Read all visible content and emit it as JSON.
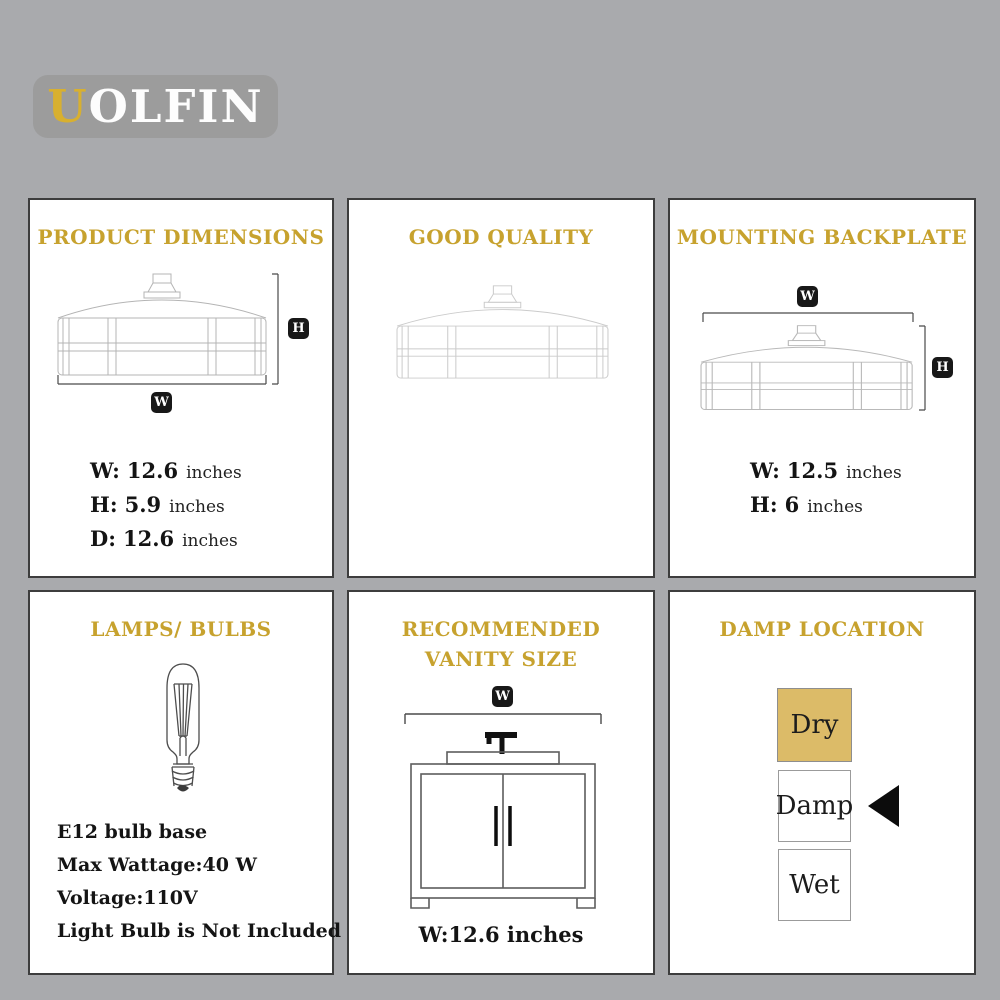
{
  "logo": {
    "first": "U",
    "rest": "OLFIN"
  },
  "badges": {
    "width": "W",
    "height": "H"
  },
  "cards": {
    "product_dimensions": {
      "title": "PRODUCT DIMENSIONS",
      "dims": [
        {
          "label": "W:",
          "value": "12.6",
          "unit": "inches"
        },
        {
          "label": "H:",
          "value": "5.9",
          "unit": "inches"
        },
        {
          "label": "D:",
          "value": "12.6",
          "unit": "inches"
        }
      ]
    },
    "good_quality": {
      "title": "GOOD QUALITY"
    },
    "mounting_backplate": {
      "title": "MOUNTING BACKPLATE",
      "dims": [
        {
          "label": "W:",
          "value": "12.5",
          "unit": "inches"
        },
        {
          "label": "H:",
          "value": "6",
          "unit": "inches"
        }
      ]
    },
    "lamps_bulbs": {
      "title": "LAMPS/ BULBS",
      "specs": [
        "E12 bulb base",
        "Max Wattage:40 W",
        "Voltage:110V",
        "Light Bulb is Not Included"
      ]
    },
    "vanity": {
      "title_line1": "RECOMMENDED",
      "title_line2": "VANITY SIZE",
      "width_text": "W:12.6 inches"
    },
    "damp_location": {
      "title": "DAMP LOCATION",
      "levels": [
        {
          "label": "Dry",
          "highlighted": true
        },
        {
          "label": "Damp",
          "highlighted": false
        },
        {
          "label": "Wet",
          "highlighted": false
        }
      ],
      "arrow_points_to": "Damp"
    }
  },
  "colors": {
    "background": "#a9aaad",
    "card_bg": "#ffffff",
    "card_border": "#3d3d3d",
    "gold_heading": "#c7a22e",
    "gold_fill": "#dcbb68",
    "logo_bg": "#9c9c9c",
    "logo_accent": "#d8b02f",
    "badge_bg": "#181818",
    "text": "#141414",
    "box_border": "#9b9b9b"
  }
}
